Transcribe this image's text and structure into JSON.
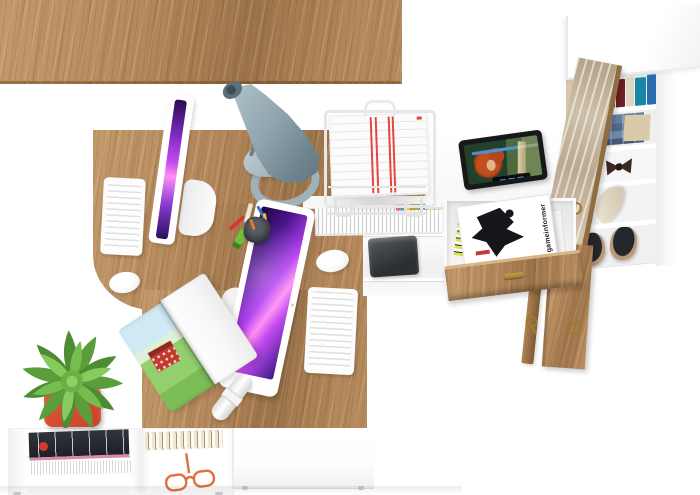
{
  "scene": {
    "magazine": {
      "title": "gameinformer"
    },
    "colors": {
      "background": "#ffffff",
      "wood": "#b5895c",
      "wood_dark": "#9d744a",
      "wood_light": "#c39a6b",
      "furniture_white": "#ffffff",
      "furniture_shadow": "#e6e6e6",
      "screen1": "#2a0a50",
      "screen2": "#c44bf0",
      "screen3": "#ff8ef5",
      "lamp_gray": "#8fa3ad",
      "lamp_dark": "#5f747e",
      "pot_red": "#c8432c",
      "plant_green": "#6fae46",
      "stripe_red": "#e2483d",
      "brass": "#9c7b2d",
      "glasses_orange": "#e0703c",
      "tablet_bezel": "#17181a",
      "progress_blue": "#4a90d9",
      "printer_dark": "#2b2e32",
      "denim": "#51688a"
    },
    "items": [
      "wooden-l-desk",
      "white-desk-return",
      "side-shelf",
      "tall-wardrobe",
      "wardrobe-door",
      "desk-lamp",
      "monitor-1",
      "monitor-2",
      "keyboard-1",
      "keyboard-2",
      "mouse-1",
      "mouse-2",
      "document-tray",
      "tablet-video-player",
      "pencil-cup",
      "open-magazine",
      "paper-roll",
      "potted-succulent",
      "open-magazine-drawer",
      "cabinet-door-face",
      "cabinet-door-edge",
      "brass-key",
      "dvd-shelf",
      "printer",
      "bottom-shelf-unit",
      "bottom-drawer-cabinet",
      "sneakers",
      "heel-shoe",
      "bow-slippers",
      "folded-jeans",
      "book-row",
      "reading-glasses",
      "magazine-stack"
    ]
  }
}
